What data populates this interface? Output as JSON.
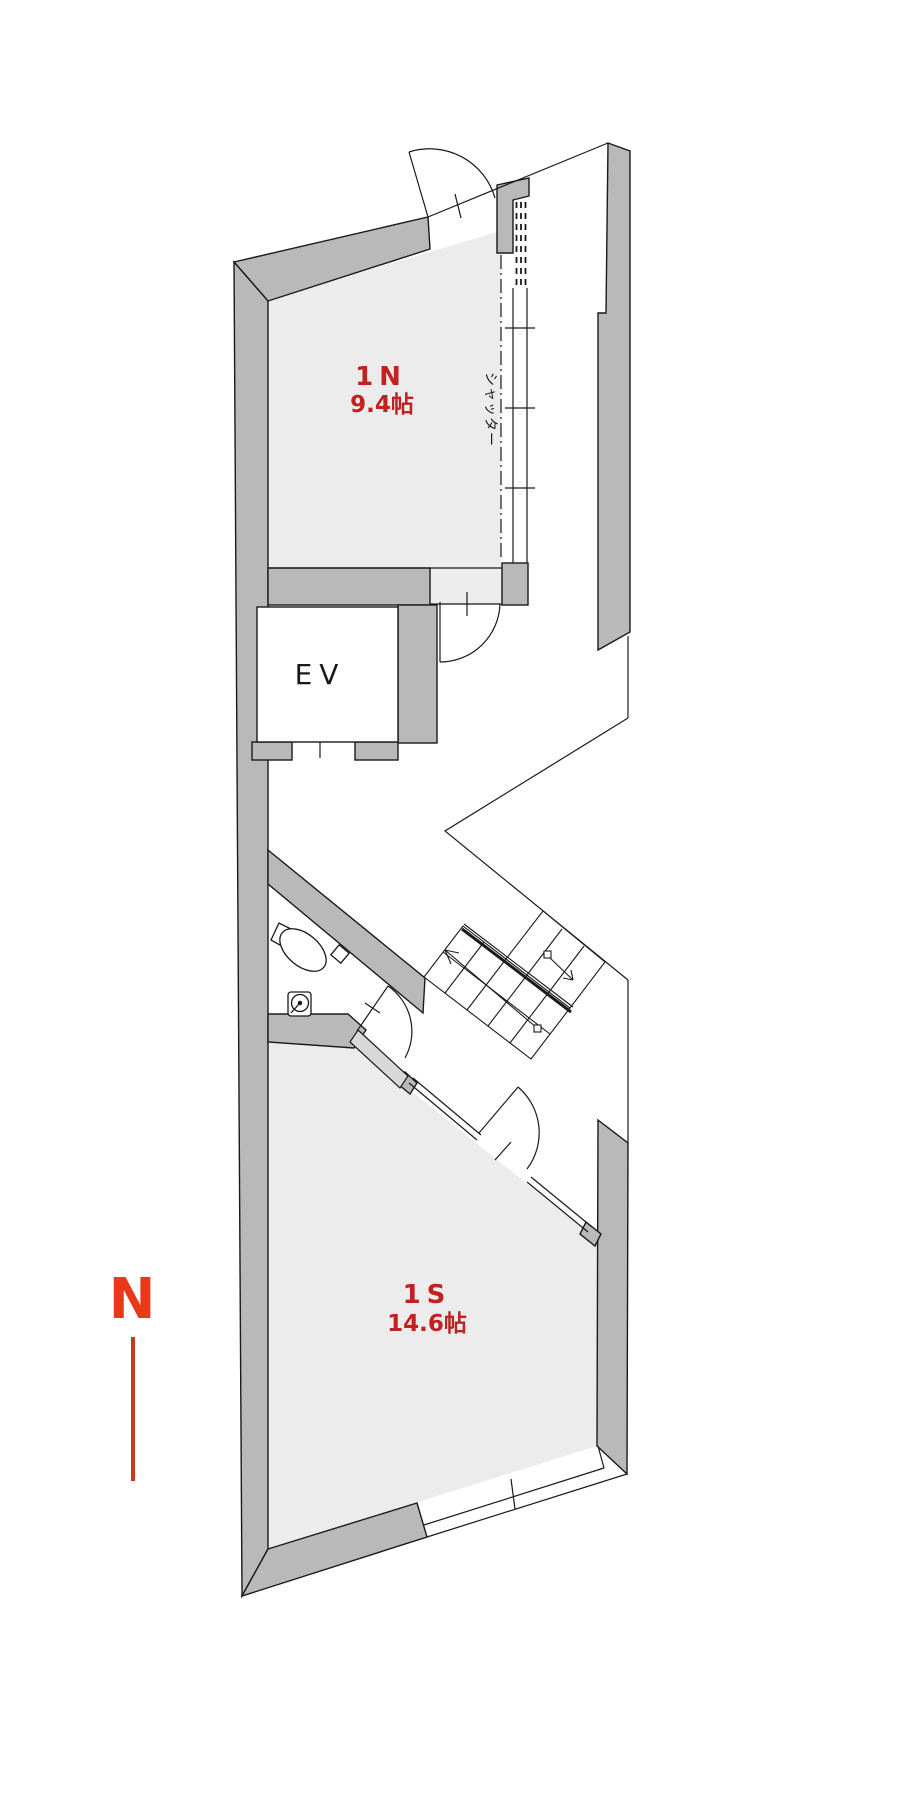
{
  "colors": {
    "wall": "#b9b9b9",
    "wall_light": "#d8d8d8",
    "room_fill": "#ececec",
    "line": "#1a1a1a",
    "white": "#ffffff",
    "label_red": "#c22121",
    "compass_red": "#e8391a",
    "compass_line": "#c43a26"
  },
  "rooms": [
    {
      "label": "1N",
      "area": "9.4帖"
    },
    {
      "label": "1S",
      "area": "14.6帖"
    }
  ],
  "elevator": {
    "label": "EV"
  },
  "labels": {
    "shutter": "シャッター"
  },
  "compass": {
    "label": "N"
  }
}
